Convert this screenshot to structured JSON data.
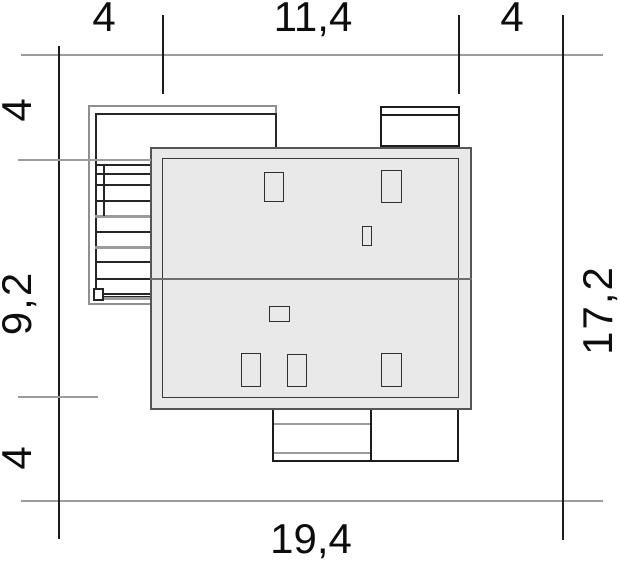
{
  "title": "house site plan with plot dimensions",
  "dimensions": {
    "top_segments": [
      "4",
      "11,4",
      "4"
    ],
    "left_segments": [
      "4",
      "9,2",
      "4"
    ],
    "bottom_total": "19,4",
    "right_total": "17,2"
  },
  "colors": {
    "paper": "#ffffff",
    "roof-fill": "#e9e9e9",
    "roof-edge": "#555555",
    "line-dark": "#1c1c1c",
    "line-gray": "#9c9c9c",
    "ink": "#0d0d0d"
  }
}
